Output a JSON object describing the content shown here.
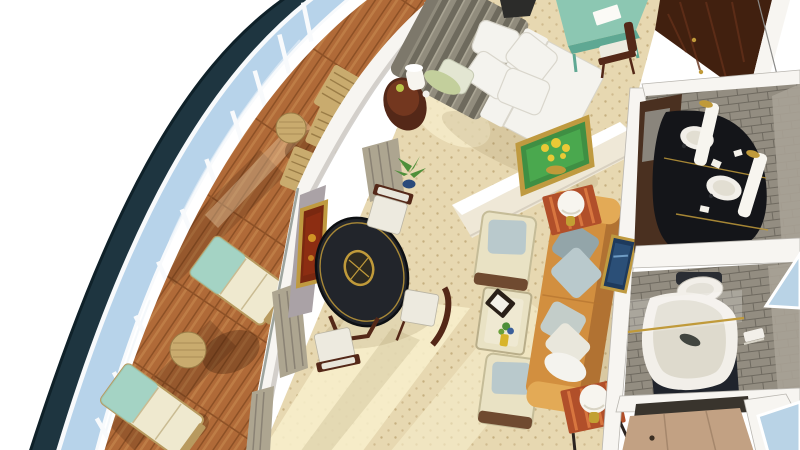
{
  "palette": {
    "background": "#ffffff",
    "hull": "#1e3540",
    "hull_edge": "#0f2129",
    "glass": "#b7d3ea",
    "glass_light": "#dce9f4",
    "rail": "#f8fafc",
    "deck_wood": "#b06a38",
    "plank_dark": "#8d5126",
    "plank_light": "#c98c52",
    "deck_shadow": "#3a1c08",
    "slat_wood": "#c9ab6e",
    "lounge_cream": "#efe9cf",
    "lounge_teal": "#96cfc2",
    "lounge_frame": "#b89a5f",
    "wall_white": "#f7f5f1",
    "wall_shade": "#c9c6c0",
    "wall_cream": "#efe8d7",
    "wall_mauve": "#aaa2a6",
    "curtain": "#ada590",
    "curtain_dark": "#8a8274",
    "carpet": "#e7d8b1",
    "carpet_dot": "#c6b080",
    "carpet_sun": "#f8f0cd",
    "floor_shadow": "#8a744a",
    "duvet": "#918c7d",
    "duvet_dark": "#6e6a5d",
    "linen": "#f4f3ee",
    "linen_shade": "#d9d6cc",
    "bolster_green": "#c3cf9c",
    "headboard": "#7d786b",
    "wood_dark": "#542818",
    "wood_mid": "#7b3b22",
    "table_black": "#22252b",
    "gold": "#c09a3a",
    "seat_white": "#edeadf",
    "armchair": "#e9e2c4",
    "armchair_trim": "#6f4a30",
    "pillow_blue": "#b9c9cc",
    "pillow_grey": "#93a5a9",
    "sofa": "#d28f3f",
    "sofa_dark": "#b17232",
    "sofa_arm": "#e3aa56",
    "side_table": "#b14f2a",
    "side_table_stripe": "#d8763f",
    "lamp_white": "#f7f5ef",
    "brass": "#c2a033",
    "painting_green": "#4aa84e",
    "painting_yellow": "#e9c936",
    "painting_red": "#8c2d12",
    "painting_blue": "#2b4f77",
    "frame_gold": "#bf9a40",
    "wardrobe": "#41200f",
    "wardrobe_grain": "#63301a",
    "desk_teal": "#8cc7b2",
    "desk_teal_dark": "#5fa893",
    "tile": "#938d81",
    "tile_grout": "#6f6a60",
    "tile_wall": "#a8a296",
    "counter": "#141519",
    "porcelain": "#f2efe9",
    "tub_base": "#20242c",
    "door_tan": "#c2a183",
    "hall_floor": "#39342d",
    "sea_glass": "#b9d3e6",
    "plant_green": "#4e8f3a",
    "vase_blue": "#2a4a7a"
  },
  "scene": {
    "objects": [
      "ship-hull",
      "balcony-glass-railing",
      "railing-posts",
      "balcony-deck",
      "lounge-chair",
      "deck-side-table",
      "slat-deck-chair",
      "deck-bench",
      "suite-exterior-wall",
      "curtains",
      "bed",
      "bed-pillows",
      "nightstand",
      "nightstand-lamp",
      "writing-desk",
      "desk-chair",
      "wardrobe",
      "flower-painting",
      "abstract-painting",
      "seascape-painting",
      "dining-table",
      "dining-chair",
      "centerpiece-bowl",
      "potted-plant",
      "armchair",
      "coffee-table",
      "flower-vase",
      "sofa",
      "sofa-cushion",
      "side-table",
      "globe-lamp",
      "vanity-counter",
      "vanity-sink",
      "pillar-lamp",
      "bathroom-door",
      "bathtub",
      "toilet",
      "towel-rack",
      "entry-door",
      "sea-view"
    ]
  }
}
